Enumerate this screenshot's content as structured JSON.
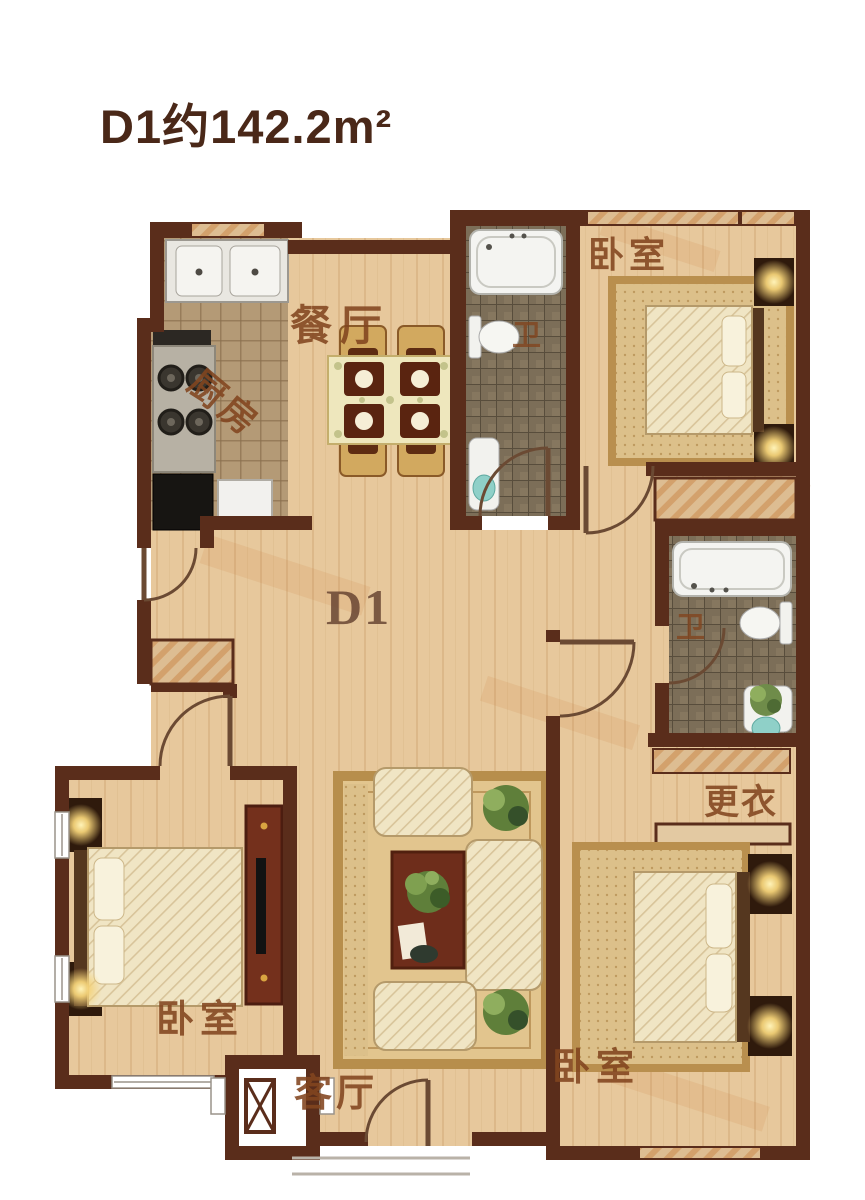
{
  "title": "D1约142.2m²",
  "unit": {
    "code": "D1",
    "area_text": "约142.2m²"
  },
  "rooms": {
    "dining": "餐厅",
    "kitchen": "厨房",
    "bedroom_top_right": "卧室",
    "bedroom_bottom_left": "卧室",
    "bedroom_bottom_right": "卧室",
    "bathroom_top": "卫",
    "bathroom_middle": "卫",
    "dressing_room": "更衣",
    "living_room": "客厅",
    "unit_marker": "D1"
  },
  "colors": {
    "wall": "#5a2d1b",
    "wood_floor": "#e7c89c",
    "bath_tile": "#7c6e58",
    "kitchen_tile": "#b49a76",
    "rug": "#e2c58e",
    "label_text": "#82451f",
    "title_text": "#4a2818",
    "accent_stripe": "#c97f3f"
  }
}
